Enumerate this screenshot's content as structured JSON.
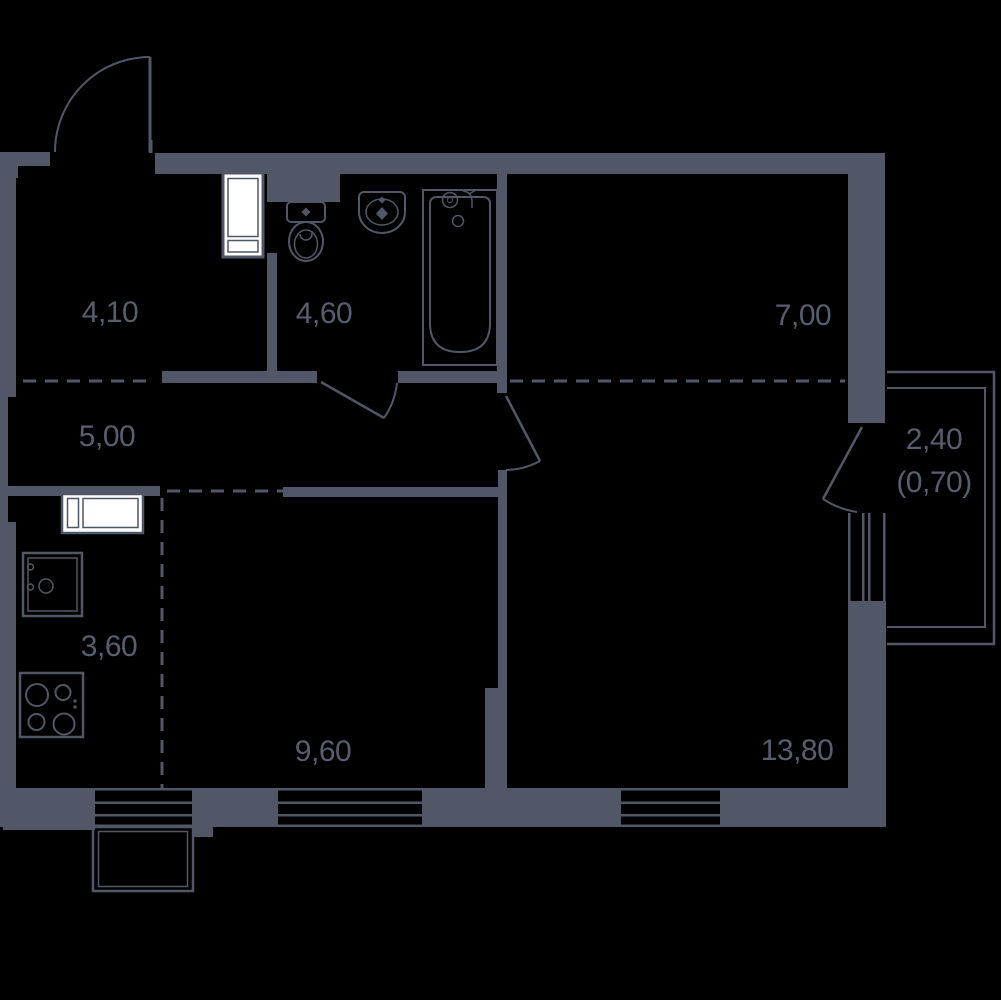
{
  "plan": {
    "title": "apartment-floor-plan",
    "background_color": "#000000",
    "wall_color": "#515766",
    "label_color": "#585E6F",
    "fixture_fill_color": "#ffffff",
    "rooms": [
      {
        "name": "entry-hall",
        "area": "4,10"
      },
      {
        "name": "bathroom",
        "area": "4,60"
      },
      {
        "name": "room-upper-right",
        "area": "7,00"
      },
      {
        "name": "corridor",
        "area": "5,00"
      },
      {
        "name": "kitchen",
        "area": "3,60"
      },
      {
        "name": "room-lower-left",
        "area": "9,60"
      },
      {
        "name": "living-room",
        "area": "13,80"
      },
      {
        "name": "balcony",
        "area": "2,40",
        "area_reduced": "(0,70)"
      }
    ]
  }
}
